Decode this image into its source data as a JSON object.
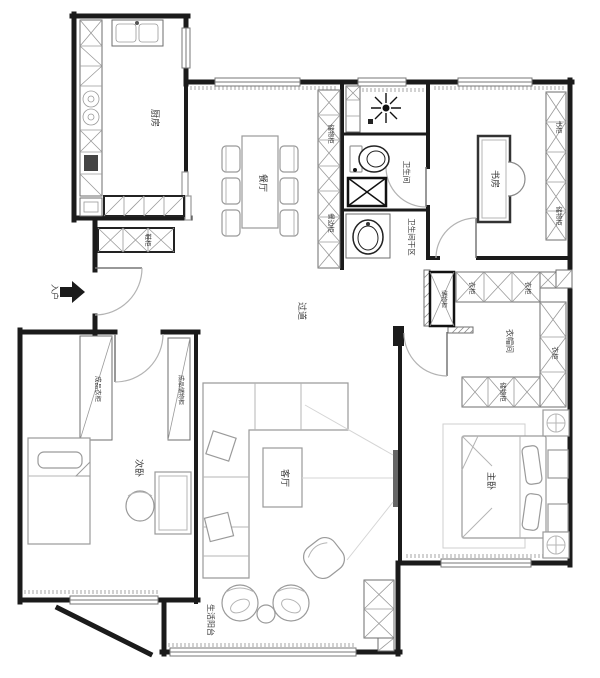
{
  "plan": {
    "labels": {
      "kitchen": "厨房",
      "dining": "餐厅",
      "bath_wet": "卫生间",
      "bath_dry": "卫生间干区",
      "study": "书房",
      "bookcase": "书柜",
      "study_storage": "储物柜",
      "corridor": "过道",
      "entry": "入户",
      "shoe_cabinet": "鞋柜",
      "hall_storage": "储物柜",
      "sideboard": "餐边柜",
      "closet_room": "衣帽间",
      "wardrobe_a": "衣柜",
      "wardrobe_b": "衣柜",
      "wardrobe_c": "衣柜",
      "closet_storage_a": "储物柜",
      "closet_storage_b": "储物柜",
      "master": "主卧",
      "living": "客厅",
      "secondary": "次卧",
      "ready_wardrobe": "成品衣柜",
      "ready_storage": "成品储物柜",
      "balcony": "生活阳台"
    },
    "colors": {
      "wall": "#1b1b1b",
      "cabinet_line": "#6e6e6e",
      "furniture_line": "#9a9a9a",
      "door_arc": "#b3b3b3",
      "label": "#3a3a3a"
    }
  }
}
